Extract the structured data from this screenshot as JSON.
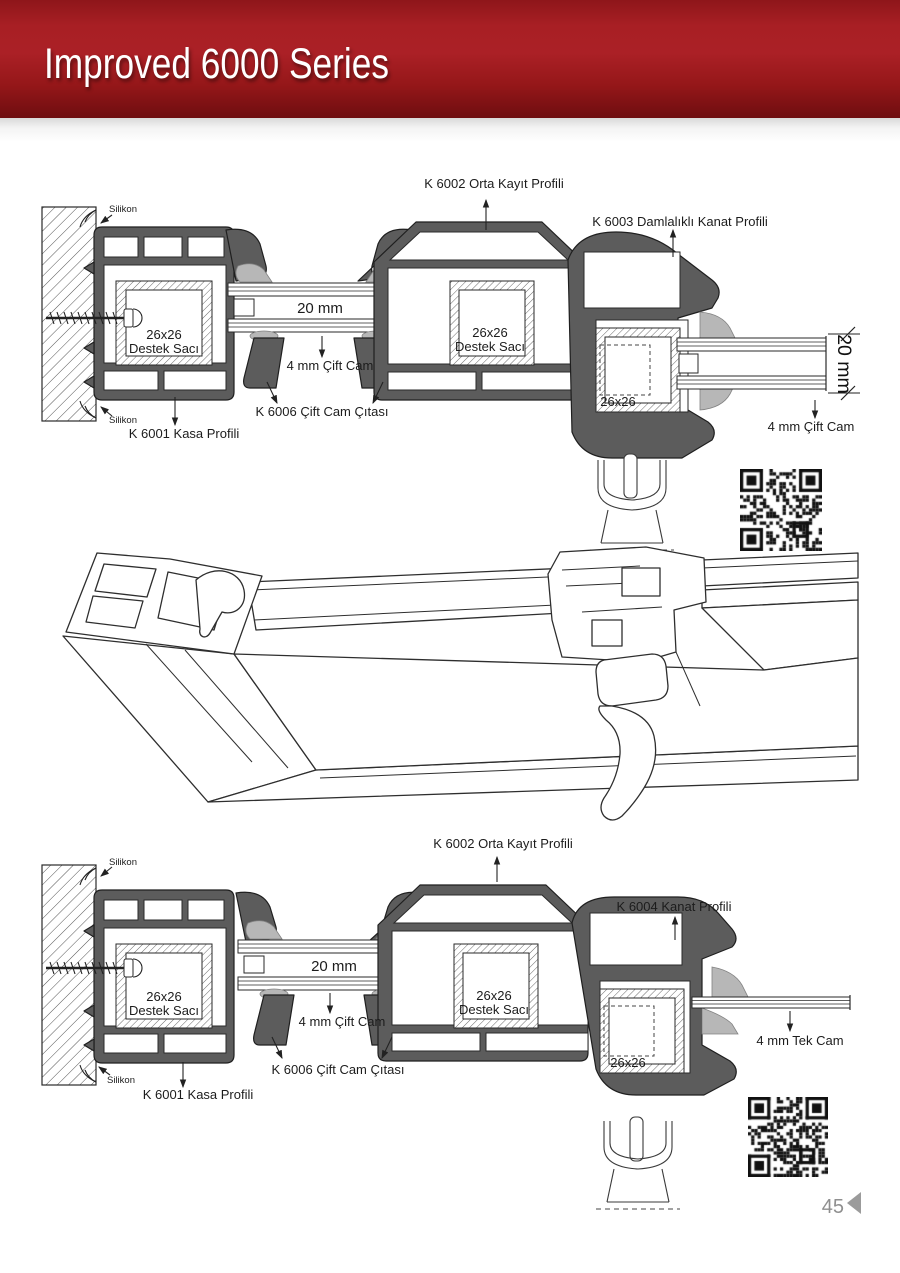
{
  "header": {
    "title": "Improved 6000 Series"
  },
  "top": {
    "k6002": "K 6002 Orta Kayıt Profili",
    "k6003": "K 6003 Damlalıklı Kanat Profili",
    "silikon_top": "Silikon",
    "silikon_bottom": "Silikon",
    "reinf_left1": "26x26",
    "reinf_left2": "Destek Sacı",
    "reinf_mid1": "26x26",
    "reinf_mid2": "Destek Sacı",
    "reinf_sash": "26x26",
    "glass_width": "20 mm",
    "cift_cam_left": "4 mm Çift Cam",
    "cift_cam_right": "4 mm Çift Cam",
    "dim_right": "20 mm",
    "k6006": "K 6006 Çift Cam Çıtası",
    "k6001": "K 6001 Kasa Profili"
  },
  "bottom": {
    "k6002": "K 6002 Orta Kayıt Profili",
    "k6004": "K 6004 Kanat Profili",
    "silikon_top": "Silikon",
    "silikon_bottom": "Silikon",
    "reinf_left1": "26x26",
    "reinf_left2": "Destek Sacı",
    "reinf_mid1": "26x26",
    "reinf_mid2": "Destek Sacı",
    "reinf_sash": "26x26",
    "glass_width": "20 mm",
    "cift_cam_left": "4 mm Çift Cam",
    "tek_cam": "4 mm Tek Cam",
    "k6006": "K 6006 Çift Cam Çıtası",
    "k6001": "K 6001 Kasa Profili"
  },
  "footer": {
    "page_number": "45"
  },
  "icons": {
    "top_qr": "qr-code",
    "bottom_qr": "qr-code",
    "corner": "page-corner-triangle"
  },
  "colors": {
    "banner_red": "#a81f24",
    "banner_red_dark": "#6e0d10",
    "profile_gray": "#5c5c5c",
    "gasket_gray": "#b7b7b7",
    "page_number_gray": "#8f8f8f"
  }
}
